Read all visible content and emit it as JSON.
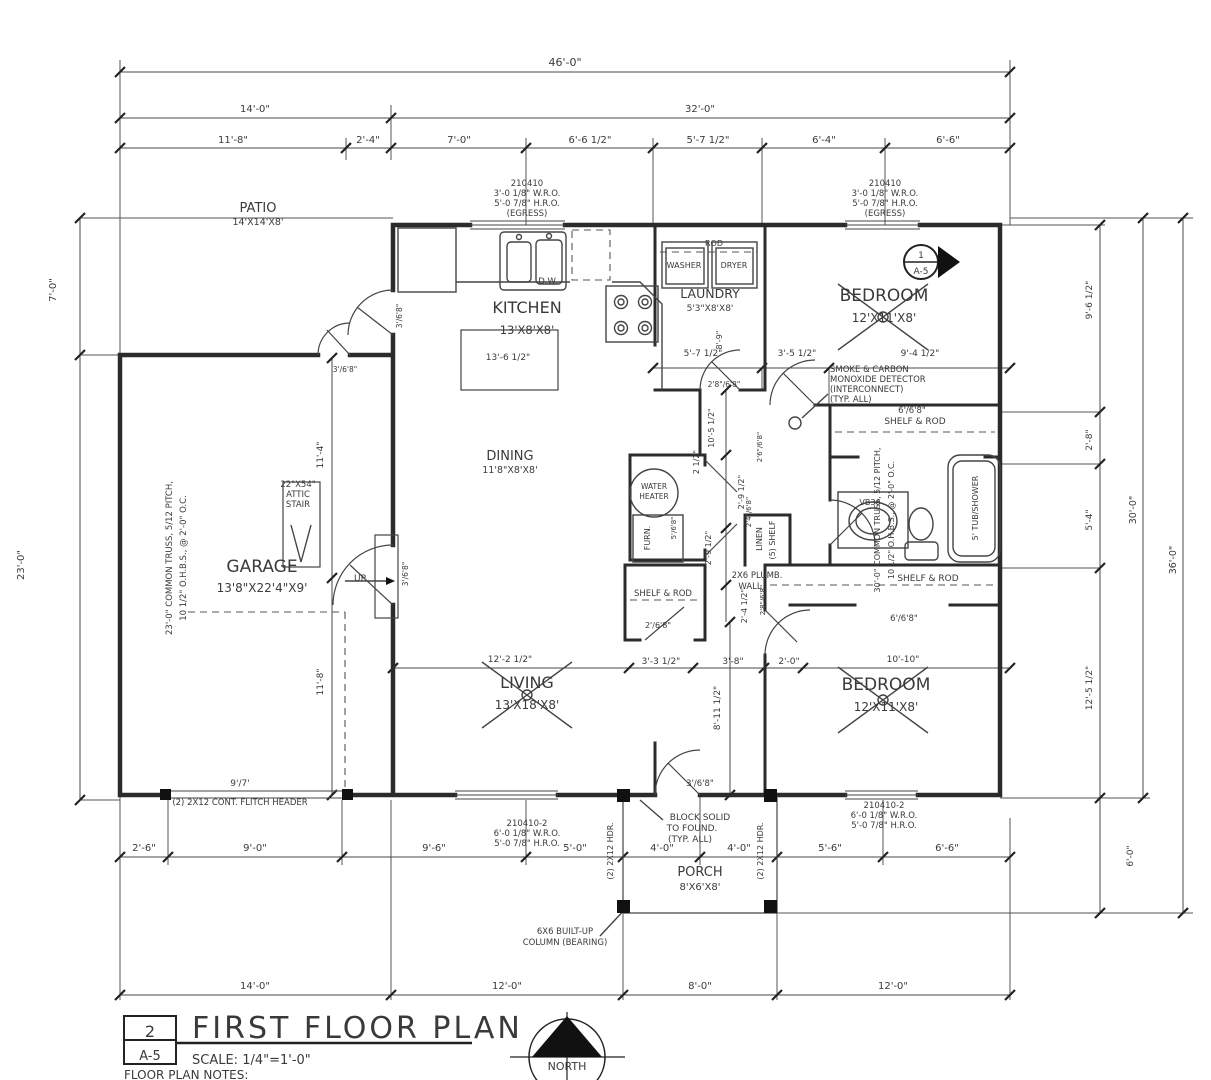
{
  "title_block": {
    "detail_number": "2",
    "sheet": "A-5",
    "title": "FIRST FLOOR PLAN",
    "scale": "SCALE: 1/4\"=1'-0\"",
    "notes_heading": "FLOOR PLAN NOTES:"
  },
  "north_arrow": {
    "label": "NORTH"
  },
  "detail_marker": {
    "number": "1",
    "sheet": "A-5"
  },
  "annotations": {
    "dims_top": [
      {
        "t": "46'-0\"",
        "x": 565,
        "y": 66,
        "s": 11
      },
      {
        "t": "14'-0\"",
        "x": 255,
        "y": 112,
        "s": 10
      },
      {
        "t": "32'-0\"",
        "x": 700,
        "y": 112,
        "s": 10
      },
      {
        "t": "11'-8\"",
        "x": 233,
        "y": 143,
        "s": 10
      },
      {
        "t": "2'-4\"",
        "x": 368,
        "y": 143,
        "s": 10
      },
      {
        "t": "7'-0\"",
        "x": 459,
        "y": 143,
        "s": 10
      },
      {
        "t": "6'-6 1/2\"",
        "x": 590,
        "y": 143,
        "s": 10
      },
      {
        "t": "5'-7 1/2\"",
        "x": 708,
        "y": 143,
        "s": 10
      },
      {
        "t": "6'-4\"",
        "x": 824,
        "y": 143,
        "s": 10
      },
      {
        "t": "6'-6\"",
        "x": 948,
        "y": 143,
        "s": 10
      }
    ],
    "dims_bottom": [
      {
        "t": "2'-6\"",
        "x": 144,
        "y": 851,
        "s": 10
      },
      {
        "t": "9'-0\"",
        "x": 255,
        "y": 851,
        "s": 10
      },
      {
        "t": "9'-6\"",
        "x": 434,
        "y": 851,
        "s": 10
      },
      {
        "t": "5'-0\"",
        "x": 575,
        "y": 851,
        "s": 10
      },
      {
        "t": "4'-0\"",
        "x": 662,
        "y": 851,
        "s": 10
      },
      {
        "t": "4'-0\"",
        "x": 739,
        "y": 851,
        "s": 10
      },
      {
        "t": "5'-6\"",
        "x": 830,
        "y": 851,
        "s": 10
      },
      {
        "t": "6'-6\"",
        "x": 947,
        "y": 851,
        "s": 10
      },
      {
        "t": "14'-0\"",
        "x": 255,
        "y": 989,
        "s": 10
      },
      {
        "t": "12'-0\"",
        "x": 507,
        "y": 989,
        "s": 10
      },
      {
        "t": "8'-0\"",
        "x": 700,
        "y": 989,
        "s": 10
      },
      {
        "t": "12'-0\"",
        "x": 893,
        "y": 989,
        "s": 10
      }
    ],
    "dims_left": [
      {
        "t": "7'-0\"",
        "x": 56,
        "y": 290,
        "s": 10,
        "r": -90
      },
      {
        "t": "23'-0\"",
        "x": 24,
        "y": 565,
        "s": 10,
        "r": -90
      }
    ],
    "dims_right": [
      {
        "t": "9'-6 1/2\"",
        "x": 1092,
        "y": 300,
        "s": 9,
        "r": -90
      },
      {
        "t": "2'-8\"",
        "x": 1092,
        "y": 440,
        "s": 9,
        "r": -90
      },
      {
        "t": "5'-4\"",
        "x": 1092,
        "y": 520,
        "s": 9,
        "r": -90
      },
      {
        "t": "12'-5 1/2\"",
        "x": 1092,
        "y": 688,
        "s": 9,
        "r": -90
      },
      {
        "t": "6'-0\"",
        "x": 1133,
        "y": 856,
        "s": 9,
        "r": -90
      },
      {
        "t": "30'-0\"",
        "x": 1136,
        "y": 510,
        "s": 9.5,
        "r": -90
      },
      {
        "t": "36'-0\"",
        "x": 1176,
        "y": 560,
        "s": 9.5,
        "r": -90
      }
    ],
    "dims_interior": [
      {
        "t": "13'-6 1/2\"",
        "x": 508,
        "y": 360,
        "s": 9
      },
      {
        "t": "5'-7 1/2\"",
        "x": 703,
        "y": 356,
        "s": 9
      },
      {
        "t": "3'-5 1/2\"",
        "x": 797,
        "y": 356,
        "s": 9
      },
      {
        "t": "9'-4 1/2\"",
        "x": 920,
        "y": 356,
        "s": 9
      },
      {
        "t": "8'-9\"",
        "x": 722,
        "y": 340,
        "s": 8,
        "r": -90
      },
      {
        "t": "10'-5 1/2\"",
        "x": 714,
        "y": 428,
        "s": 8,
        "r": -90
      },
      {
        "t": "2 1/2\"",
        "x": 699,
        "y": 462,
        "s": 8,
        "r": -90
      },
      {
        "t": "2'-9 1/2\"",
        "x": 744,
        "y": 492,
        "s": 8,
        "r": -90
      },
      {
        "t": "2'-9 1/2\"",
        "x": 711,
        "y": 548,
        "s": 8,
        "r": -90
      },
      {
        "t": "2'-4 1/2\"",
        "x": 747,
        "y": 606,
        "s": 8,
        "r": -90
      },
      {
        "t": "12'-2 1/2\"",
        "x": 510,
        "y": 662,
        "s": 9
      },
      {
        "t": "3'-3 1/2\"",
        "x": 661,
        "y": 664,
        "s": 9
      },
      {
        "t": "3'-8\"",
        "x": 733,
        "y": 664,
        "s": 9
      },
      {
        "t": "2'-0\"",
        "x": 789,
        "y": 664,
        "s": 9
      },
      {
        "t": "10'-10\"",
        "x": 903,
        "y": 662,
        "s": 9
      },
      {
        "t": "8'-11 1/2\"",
        "x": 720,
        "y": 708,
        "s": 9,
        "r": -90
      },
      {
        "t": "11'-4\"",
        "x": 323,
        "y": 455,
        "s": 9,
        "r": -90
      },
      {
        "t": "11'-8\"",
        "x": 323,
        "y": 682,
        "s": 9,
        "r": -90
      },
      {
        "t": "9'/7'",
        "x": 240,
        "y": 786,
        "s": 9
      }
    ],
    "rooms": [
      {
        "t": "PATIO",
        "x": 258,
        "y": 212,
        "s": 13
      },
      {
        "t": "14'X14'X8'",
        "x": 258,
        "y": 225,
        "s": 9.5
      },
      {
        "t": "KITCHEN",
        "x": 527,
        "y": 313,
        "s": 16
      },
      {
        "t": "13'X8'X8'",
        "x": 527,
        "y": 334,
        "s": 11.5
      },
      {
        "t": "DINING",
        "x": 510,
        "y": 460,
        "s": 13
      },
      {
        "t": "11'8\"X8'X8'",
        "x": 510,
        "y": 473,
        "s": 9.5
      },
      {
        "t": "LAUNDRY",
        "x": 710,
        "y": 298,
        "s": 12.5
      },
      {
        "t": "5'3\"X8'X8'",
        "x": 710,
        "y": 311,
        "s": 9
      },
      {
        "t": "BEDROOM",
        "x": 884,
        "y": 301,
        "s": 17
      },
      {
        "t": "12'X11'X8'",
        "x": 884,
        "y": 322,
        "s": 12
      },
      {
        "t": "GARAGE",
        "x": 262,
        "y": 572,
        "s": 17
      },
      {
        "t": "13'8\"X22'4\"X9'",
        "x": 262,
        "y": 592,
        "s": 12
      },
      {
        "t": "LIVING",
        "x": 527,
        "y": 688,
        "s": 16
      },
      {
        "t": "13'X18'X8'",
        "x": 527,
        "y": 709,
        "s": 12
      },
      {
        "t": "BEDROOM",
        "x": 886,
        "y": 690,
        "s": 17
      },
      {
        "t": "12'X11'X8'",
        "x": 886,
        "y": 711,
        "s": 12
      },
      {
        "t": "PORCH",
        "x": 700,
        "y": 876,
        "s": 13
      },
      {
        "t": "8'X6'X8'",
        "x": 700,
        "y": 890,
        "s": 10
      }
    ],
    "fixtures": [
      {
        "t": "D.W.",
        "x": 548,
        "y": 284,
        "s": 8.5
      },
      {
        "t": "ROD",
        "x": 714,
        "y": 246,
        "s": 8
      },
      {
        "t": "WASHER",
        "x": 684,
        "y": 268,
        "s": 8
      },
      {
        "t": "DRYER",
        "x": 734,
        "y": 268,
        "s": 8
      },
      {
        "t": "WATER",
        "x": 654,
        "y": 489,
        "s": 7.5
      },
      {
        "t": "HEATER",
        "x": 654,
        "y": 499,
        "s": 7.5
      },
      {
        "t": "FURN.",
        "x": 650,
        "y": 538,
        "s": 8,
        "r": -90
      },
      {
        "t": "LINEN",
        "x": 762,
        "y": 539,
        "s": 8,
        "r": -90
      },
      {
        "t": "(5) SHELF",
        "x": 775,
        "y": 540,
        "s": 8,
        "r": -90
      },
      {
        "t": "VB36",
        "x": 870,
        "y": 505,
        "s": 8
      },
      {
        "t": "5' TUB/SHOWER",
        "x": 978,
        "y": 508,
        "s": 8,
        "r": -90
      },
      {
        "t": "SHELF & ROD",
        "x": 663,
        "y": 596,
        "s": 8.5
      },
      {
        "t": "SHELF & ROD",
        "x": 915,
        "y": 424,
        "s": 9
      },
      {
        "t": "SHELF & ROD",
        "x": 928,
        "y": 581,
        "s": 9
      },
      {
        "t": "22\"X54\"",
        "x": 298,
        "y": 487,
        "s": 8.5
      },
      {
        "t": "ATTIC",
        "x": 298,
        "y": 497,
        "s": 8.5
      },
      {
        "t": "STAIR",
        "x": 298,
        "y": 507,
        "s": 8.5
      },
      {
        "t": "UP",
        "x": 360,
        "y": 581,
        "s": 9
      }
    ],
    "window_notes": [
      {
        "t": "210410",
        "x": 527,
        "y": 186,
        "s": 8.5
      },
      {
        "t": "3'-0 1/8\" W.R.O.",
        "x": 527,
        "y": 196,
        "s": 8.5
      },
      {
        "t": "5'-0 7/8\" H.R.O.",
        "x": 527,
        "y": 206,
        "s": 8.5
      },
      {
        "t": "(EGRESS)",
        "x": 527,
        "y": 216,
        "s": 8.5
      },
      {
        "t": "210410",
        "x": 885,
        "y": 186,
        "s": 8.5
      },
      {
        "t": "3'-0 1/8\" W.R.O.",
        "x": 885,
        "y": 196,
        "s": 8.5
      },
      {
        "t": "5'-0 7/8\" H.R.O.",
        "x": 885,
        "y": 206,
        "s": 8.5
      },
      {
        "t": "(EGRESS)",
        "x": 885,
        "y": 216,
        "s": 8.5
      },
      {
        "t": "210410-2",
        "x": 527,
        "y": 826,
        "s": 8.5
      },
      {
        "t": "6'-0 1/8\" W.R.O.",
        "x": 527,
        "y": 836,
        "s": 8.5
      },
      {
        "t": "5'-0 7/8\" H.R.O.",
        "x": 527,
        "y": 846,
        "s": 8.5
      },
      {
        "t": "210410-2",
        "x": 884,
        "y": 808,
        "s": 8.5
      },
      {
        "t": "6'-0 1/8\" W.R.O.",
        "x": 884,
        "y": 818,
        "s": 8.5
      },
      {
        "t": "5'-0 7/8\" H.R.O.",
        "x": 884,
        "y": 828,
        "s": 8.5
      }
    ],
    "door_tags": [
      {
        "t": "3'/6'8\"",
        "x": 345,
        "y": 372,
        "s": 7.5
      },
      {
        "t": "3'/6'8\"",
        "x": 402,
        "y": 316,
        "s": 7.5,
        "r": -90
      },
      {
        "t": "3'/6'8\"",
        "x": 408,
        "y": 574,
        "s": 7.5,
        "r": -90
      },
      {
        "t": "2'8\"/6'8\"",
        "x": 724,
        "y": 387,
        "s": 7.5
      },
      {
        "t": "2'6\"/6'8\"",
        "x": 762,
        "y": 447,
        "s": 7,
        "r": -90
      },
      {
        "t": "2'4\"/6'8\"",
        "x": 751,
        "y": 512,
        "s": 7,
        "r": -90
      },
      {
        "t": "2'8\"/6'8\"",
        "x": 765,
        "y": 600,
        "s": 7,
        "r": -90
      },
      {
        "t": "5'/6'8\"",
        "x": 676,
        "y": 528,
        "s": 7,
        "r": -90
      },
      {
        "t": "2'/6'8\"",
        "x": 658,
        "y": 628,
        "s": 8
      },
      {
        "t": "6'/6'8\"",
        "x": 912,
        "y": 413,
        "s": 8.5
      },
      {
        "t": "6'/6'8\"",
        "x": 904,
        "y": 621,
        "s": 8.5
      },
      {
        "t": "3'/6'8\"",
        "x": 700,
        "y": 786,
        "s": 8.5
      }
    ],
    "notes": [
      {
        "t": "SMOKE & CARBON",
        "x": 830,
        "y": 372,
        "s": 8.5,
        "a": "s"
      },
      {
        "t": "MONOXIDE DETECTOR",
        "x": 830,
        "y": 382,
        "s": 8.5,
        "a": "s"
      },
      {
        "t": "(INTERCONNECT)",
        "x": 830,
        "y": 392,
        "s": 8.5,
        "a": "s"
      },
      {
        "t": "(TYP. ALL)",
        "x": 830,
        "y": 402,
        "s": 8.5,
        "a": "s"
      },
      {
        "t": "23'-0\" COMMON TRUSS, 5/12 PITCH,",
        "x": 172,
        "y": 558,
        "s": 8.5,
        "r": -90
      },
      {
        "t": "10 1/2\" O.H.B.S., @ 2'-0\" O.C.",
        "x": 186,
        "y": 558,
        "s": 8.5,
        "r": -90
      },
      {
        "t": "30'-0\" COMMON TRUSS, 5/12 PITCH,",
        "x": 880,
        "y": 520,
        "s": 8,
        "r": -90
      },
      {
        "t": "10 1/2\" O.H.B.S., @ 2'-0\" O.C.",
        "x": 894,
        "y": 520,
        "s": 8,
        "r": -90
      },
      {
        "t": "2X6 PLUMB.",
        "x": 757,
        "y": 578,
        "s": 8.5
      },
      {
        "t": "WALL",
        "x": 750,
        "y": 589,
        "s": 8.5
      },
      {
        "t": "(2) 2X12 CONT. FLITCH HEADER",
        "x": 240,
        "y": 805,
        "s": 8.5
      },
      {
        "t": "BLOCK SOLID",
        "x": 700,
        "y": 820,
        "s": 9
      },
      {
        "t": "TO FOUND.",
        "x": 692,
        "y": 831,
        "s": 9
      },
      {
        "t": "(TYP. ALL)",
        "x": 690,
        "y": 842,
        "s": 9
      },
      {
        "t": "(2) 2X12 HDR.",
        "x": 613,
        "y": 851,
        "s": 8,
        "r": -90
      },
      {
        "t": "(2) 2X12 HDR.",
        "x": 763,
        "y": 851,
        "s": 8,
        "r": -90
      },
      {
        "t": "6X6 BUILT-UP",
        "x": 565,
        "y": 934,
        "s": 8.5
      },
      {
        "t": "COLUMN (BEARING)",
        "x": 565,
        "y": 945,
        "s": 8.5
      }
    ]
  }
}
